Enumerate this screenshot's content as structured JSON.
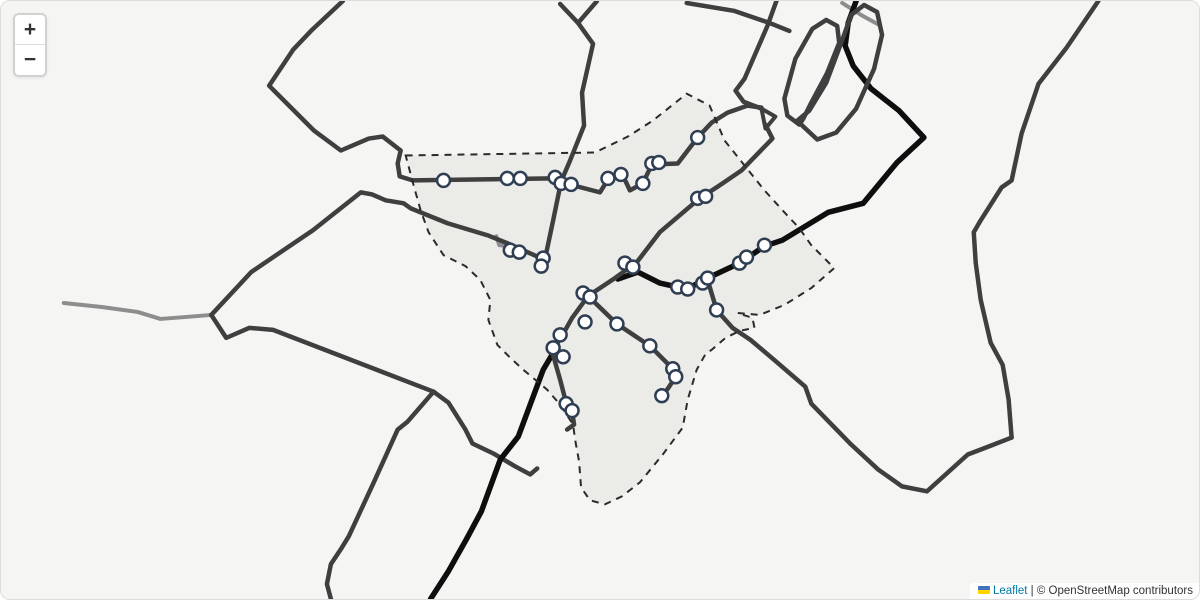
{
  "controls": {
    "zoom_in_label": "+",
    "zoom_out_label": "−"
  },
  "attribution": {
    "flag_icon": "ukraine-flag",
    "link_label": "Leaflet",
    "separator": " | ",
    "text": "© OpenStreetMap contributors"
  },
  "map": {
    "colors": {
      "background": "#f5f5f3",
      "boundary_fill": "#e7e7e4",
      "boundary_stroke": "#2b2b2b",
      "road_dark": "#3f3f3f",
      "road_light": "#8d8d8d",
      "route_black": "#0e0e0e",
      "marker_fill": "#ffffff",
      "marker_stroke": "#2f3e52"
    },
    "boundary": {
      "points": [
        [
          405,
          155
        ],
        [
          595,
          152
        ],
        [
          628,
          136
        ],
        [
          653,
          120
        ],
        [
          687,
          93
        ],
        [
          710,
          105
        ],
        [
          725,
          140
        ],
        [
          745,
          165
        ],
        [
          765,
          190
        ],
        [
          785,
          212
        ],
        [
          800,
          228
        ],
        [
          812,
          245
        ],
        [
          835,
          268
        ],
        [
          812,
          288
        ],
        [
          785,
          305
        ],
        [
          760,
          315
        ],
        [
          738,
          313
        ],
        [
          753,
          318
        ],
        [
          755,
          328
        ],
        [
          740,
          331
        ],
        [
          726,
          338
        ],
        [
          712,
          350
        ],
        [
          706,
          354
        ],
        [
          697,
          370
        ],
        [
          688,
          400
        ],
        [
          683,
          428
        ],
        [
          663,
          455
        ],
        [
          640,
          483
        ],
        [
          622,
          497
        ],
        [
          605,
          505
        ],
        [
          590,
          501
        ],
        [
          581,
          488
        ],
        [
          579,
          462
        ],
        [
          575,
          440
        ],
        [
          573,
          425
        ],
        [
          560,
          405
        ],
        [
          547,
          390
        ],
        [
          523,
          370
        ],
        [
          510,
          358
        ],
        [
          497,
          345
        ],
        [
          488,
          320
        ],
        [
          490,
          300
        ],
        [
          480,
          280
        ],
        [
          465,
          266
        ],
        [
          443,
          255
        ],
        [
          428,
          232
        ],
        [
          420,
          210
        ],
        [
          413,
          185
        ]
      ],
      "dash": "7 6",
      "stroke_width": 2
    },
    "roads": [
      {
        "name": "road-west-light",
        "color": "road_light",
        "width": 4,
        "points": [
          [
            62,
            303
          ],
          [
            100,
            307
          ],
          [
            136,
            312
          ],
          [
            159,
            319
          ],
          [
            185,
            317
          ],
          [
            210,
            315
          ]
        ]
      },
      {
        "name": "road-stub-light-town",
        "color": "road_light",
        "width": 4,
        "points": [
          [
            496,
            236
          ],
          [
            499,
            245
          ],
          [
            523,
            248
          ]
        ]
      },
      {
        "name": "road-stub-light-north",
        "color": "road_light",
        "width": 4,
        "points": [
          [
            843,
            2
          ],
          [
            862,
            14
          ],
          [
            880,
            24
          ]
        ]
      },
      {
        "name": "route-black-north",
        "color": "route_black",
        "width": 5.5,
        "points": [
          [
            857,
            0
          ],
          [
            849,
            22
          ],
          [
            846,
            45
          ],
          [
            854,
            65
          ],
          [
            872,
            88
          ],
          [
            900,
            110
          ],
          [
            925,
            137
          ],
          [
            898,
            162
          ],
          [
            864,
            203
          ],
          [
            829,
            212
          ],
          [
            783,
            240
          ],
          [
            765,
            246
          ],
          [
            740,
            263
          ],
          [
            708,
            278
          ],
          [
            687,
            289
          ],
          [
            660,
            283
          ],
          [
            638,
            272
          ],
          [
            618,
            279
          ]
        ]
      },
      {
        "name": "road-top-left",
        "color": "road_dark",
        "width": 4.5,
        "points": [
          [
            342,
            0
          ],
          [
            310,
            30
          ],
          [
            292,
            49
          ],
          [
            268,
            85
          ],
          [
            313,
            130
          ],
          [
            340,
            150
          ],
          [
            368,
            138
          ],
          [
            382,
            136
          ],
          [
            400,
            150
          ],
          [
            397,
            163
          ],
          [
            399,
            176
          ],
          [
            412,
            180
          ]
        ]
      },
      {
        "name": "road-main-street",
        "color": "road_dark",
        "width": 4.5,
        "points": [
          [
            412,
            180
          ],
          [
            553,
            178
          ],
          [
            563,
            183
          ],
          [
            577,
            186
          ],
          [
            600,
            192
          ],
          [
            608,
            179
          ],
          [
            622,
            173
          ],
          [
            630,
            190
          ],
          [
            643,
            183
          ],
          [
            652,
            164
          ],
          [
            678,
            163
          ],
          [
            698,
            137
          ],
          [
            712,
            122
          ],
          [
            728,
            112
          ],
          [
            748,
            105
          ],
          [
            762,
            107
          ]
        ]
      },
      {
        "name": "road-a-north",
        "color": "road_dark",
        "width": 4.5,
        "points": [
          [
            560,
            3
          ],
          [
            578,
            22
          ],
          [
            593,
            43
          ],
          [
            582,
            92
          ],
          [
            584,
            125
          ],
          [
            570,
            160
          ],
          [
            561,
            181
          ],
          [
            553,
            220
          ],
          [
            545,
            258
          ],
          [
            541,
            268
          ]
        ]
      },
      {
        "name": "road-a-branch",
        "color": "road_dark",
        "width": 4.5,
        "points": [
          [
            597,
            0
          ],
          [
            578,
            22
          ]
        ]
      },
      {
        "name": "road-e-northwest",
        "color": "road_dark",
        "width": 4.5,
        "points": [
          [
            210,
            315
          ],
          [
            250,
            272
          ],
          [
            312,
            230
          ],
          [
            360,
            192
          ],
          [
            371,
            194
          ],
          [
            385,
            200
          ],
          [
            403,
            203
          ],
          [
            410,
            208
          ],
          [
            447,
            223
          ],
          [
            487,
            235
          ],
          [
            507,
            243
          ],
          [
            543,
            259
          ]
        ]
      },
      {
        "name": "road-d1-diagonal",
        "color": "road_dark",
        "width": 4.5,
        "points": [
          [
            210,
            315
          ],
          [
            225,
            338
          ],
          [
            248,
            328
          ],
          [
            272,
            330
          ],
          [
            433,
            392
          ]
        ]
      },
      {
        "name": "road-d1-hook",
        "color": "road_dark",
        "width": 4.5,
        "points": [
          [
            433,
            392
          ],
          [
            448,
            403
          ],
          [
            465,
            430
          ],
          [
            472,
            444
          ],
          [
            493,
            454
          ],
          [
            515,
            467
          ],
          [
            530,
            475
          ],
          [
            537,
            469
          ]
        ]
      },
      {
        "name": "road-d1-south",
        "color": "road_dark",
        "width": 4.5,
        "points": [
          [
            433,
            392
          ],
          [
            407,
            422
          ],
          [
            397,
            430
          ],
          [
            373,
            483
          ],
          [
            348,
            537
          ],
          [
            340,
            550
          ],
          [
            330,
            565
          ],
          [
            326,
            585
          ],
          [
            330,
            600
          ]
        ]
      },
      {
        "name": "road-interchange-west",
        "color": "road_dark",
        "width": 4.5,
        "points": [
          [
            777,
            0
          ],
          [
            768,
            25
          ],
          [
            745,
            78
          ],
          [
            736,
            90
          ],
          [
            744,
            101
          ],
          [
            762,
            108
          ]
        ]
      },
      {
        "name": "road-triangle-ramp",
        "color": "road_dark",
        "width": 4,
        "closed": true,
        "points": [
          [
            762,
            108
          ],
          [
            776,
            116
          ],
          [
            766,
            128
          ]
        ]
      },
      {
        "name": "road-d2-diagonal",
        "color": "road_dark",
        "width": 4.5,
        "points": [
          [
            766,
            124
          ],
          [
            773,
            138
          ],
          [
            742,
            170
          ],
          [
            720,
            185
          ],
          [
            700,
            198
          ],
          [
            660,
            232
          ],
          [
            637,
            262
          ],
          [
            615,
            278
          ],
          [
            588,
            296
          ],
          [
            572,
            318
          ],
          [
            563,
            334
          ],
          [
            552,
            352
          ]
        ]
      },
      {
        "name": "route-black-south",
        "color": "route_black",
        "width": 5.5,
        "points": [
          [
            556,
            348
          ],
          [
            543,
            370
          ],
          [
            518,
            437
          ],
          [
            500,
            460
          ],
          [
            481,
            512
          ],
          [
            466,
            540
          ],
          [
            448,
            572
          ],
          [
            430,
            600
          ]
        ]
      },
      {
        "name": "road-stub-south",
        "color": "road_dark",
        "width": 4.5,
        "points": [
          [
            552,
            352
          ],
          [
            560,
            380
          ],
          [
            566,
            403
          ],
          [
            572,
            412
          ],
          [
            574,
            425
          ],
          [
            567,
            430
          ]
        ]
      },
      {
        "name": "road-branch-b",
        "color": "road_dark",
        "width": 4.5,
        "points": [
          [
            588,
            296
          ],
          [
            617,
            324
          ],
          [
            650,
            346
          ],
          [
            673,
            369
          ],
          [
            676,
            377
          ],
          [
            668,
            389
          ],
          [
            662,
            397
          ]
        ]
      },
      {
        "name": "road-loop-southeast",
        "color": "road_dark",
        "width": 4.5,
        "points": [
          [
            708,
            280
          ],
          [
            717,
            310
          ],
          [
            733,
            328
          ],
          [
            751,
            340
          ],
          [
            777,
            362
          ],
          [
            806,
            387
          ],
          [
            812,
            404
          ],
          [
            852,
            445
          ],
          [
            879,
            470
          ],
          [
            903,
            487
          ],
          [
            928,
            492
          ],
          [
            969,
            455
          ],
          [
            990,
            447
          ],
          [
            1013,
            438
          ]
        ]
      },
      {
        "name": "road-east",
        "color": "road_dark",
        "width": 4.5,
        "points": [
          [
            1013,
            438
          ],
          [
            1010,
            400
          ],
          [
            1004,
            365
          ],
          [
            992,
            343
          ],
          [
            982,
            300
          ],
          [
            977,
            263
          ],
          [
            975,
            232
          ],
          [
            982,
            220
          ],
          [
            1003,
            187
          ],
          [
            1013,
            180
          ],
          [
            1023,
            133
          ],
          [
            1040,
            83
          ],
          [
            1068,
            47
          ],
          [
            1100,
            0
          ]
        ]
      },
      {
        "name": "road-interchange-loop-1",
        "color": "road_dark",
        "width": 4.5,
        "closed": true,
        "points": [
          [
            800,
            124
          ],
          [
            788,
            115
          ],
          [
            785,
            98
          ],
          [
            796,
            58
          ],
          [
            813,
            28
          ],
          [
            827,
            19
          ],
          [
            838,
            25
          ],
          [
            840,
            42
          ],
          [
            828,
            72
          ],
          [
            812,
            102
          ],
          [
            804,
            118
          ]
        ]
      },
      {
        "name": "road-interchange-loop-2",
        "color": "road_dark",
        "width": 4.5,
        "closed": true,
        "points": [
          [
            804,
            126
          ],
          [
            818,
            139
          ],
          [
            837,
            132
          ],
          [
            857,
            108
          ],
          [
            875,
            68
          ],
          [
            883,
            34
          ],
          [
            878,
            11
          ],
          [
            865,
            4
          ],
          [
            852,
            14
          ],
          [
            842,
            42
          ],
          [
            827,
            82
          ],
          [
            810,
            110
          ],
          [
            798,
            120
          ]
        ]
      },
      {
        "name": "road-top-stub",
        "color": "road_dark",
        "width": 4.5,
        "points": [
          [
            687,
            2
          ],
          [
            735,
            10
          ],
          [
            770,
            22
          ],
          [
            790,
            30
          ]
        ]
      }
    ],
    "markers": [
      [
        443,
        180
      ],
      [
        507,
        178
      ],
      [
        520,
        178
      ],
      [
        555,
        177
      ],
      [
        561,
        183
      ],
      [
        571,
        184
      ],
      [
        608,
        178
      ],
      [
        621,
        174
      ],
      [
        643,
        183
      ],
      [
        652,
        163
      ],
      [
        659,
        162
      ],
      [
        698,
        137
      ],
      [
        510,
        250
      ],
      [
        519,
        252
      ],
      [
        543,
        258
      ],
      [
        541,
        266
      ],
      [
        698,
        198
      ],
      [
        706,
        196
      ],
      [
        625,
        263
      ],
      [
        633,
        267
      ],
      [
        583,
        293
      ],
      [
        590,
        297
      ],
      [
        585,
        322
      ],
      [
        560,
        335
      ],
      [
        553,
        348
      ],
      [
        563,
        357
      ],
      [
        566,
        404
      ],
      [
        572,
        411
      ],
      [
        617,
        324
      ],
      [
        650,
        346
      ],
      [
        673,
        369
      ],
      [
        676,
        377
      ],
      [
        662,
        396
      ],
      [
        678,
        287
      ],
      [
        688,
        289
      ],
      [
        703,
        283
      ],
      [
        708,
        278
      ],
      [
        740,
        263
      ],
      [
        747,
        257
      ],
      [
        765,
        245
      ],
      [
        717,
        310
      ]
    ],
    "marker_radius": 6.5,
    "marker_stroke_width": 2.5
  }
}
